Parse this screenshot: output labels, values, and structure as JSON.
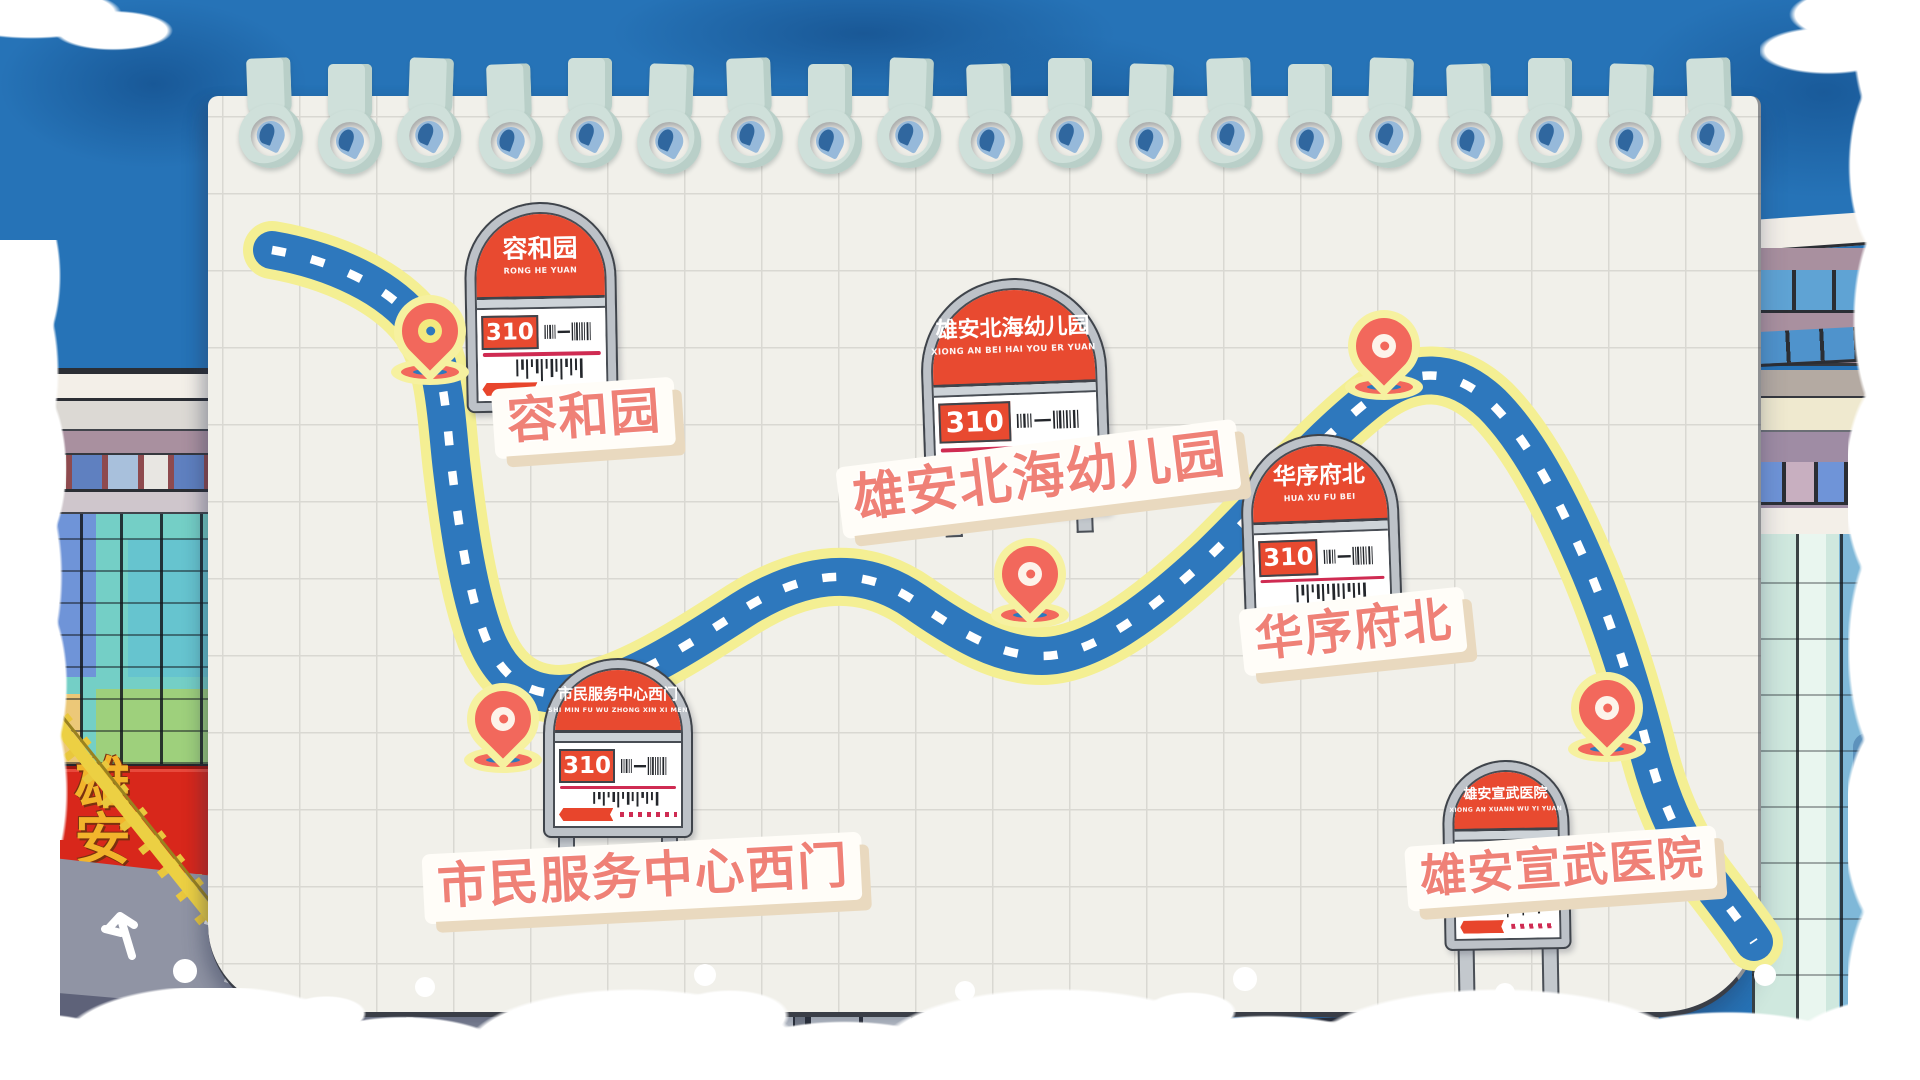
{
  "banner": {
    "name_cn": "雄 安",
    "name_en": "XIONGAN"
  },
  "route": {
    "number": "310",
    "stops": [
      {
        "name_cn": "容和园",
        "pinyin": "RONG HE YUAN",
        "route_no": "310"
      },
      {
        "name_cn": "市民服务中心西门",
        "pinyin": "SHI MIN FU WU ZHONG XIN XI MEN",
        "route_no": "310"
      },
      {
        "name_cn": "雄安北海幼儿园",
        "pinyin": "XIONG AN BEI HAI YOU ER YUAN",
        "route_no": "310"
      },
      {
        "name_cn": "华序府北",
        "pinyin": "HUA XU FU BEI",
        "route_no": "310"
      },
      {
        "name_cn": "雄安宣武医院",
        "pinyin": "XIONG AN XUANN WU YI YUAN",
        "route_no": "310"
      }
    ]
  },
  "colors": {
    "sky_blue": "#2673b7",
    "paper": "#f1f0ea",
    "road_blue": "#2e78bd",
    "road_border_yellow": "#f4ef93",
    "pin_coral": "#f2685c",
    "sign_red": "#e84a30",
    "label_coral": "#ef8177",
    "banner_red": "#d8271b",
    "banner_gold": "#f2b42c"
  }
}
